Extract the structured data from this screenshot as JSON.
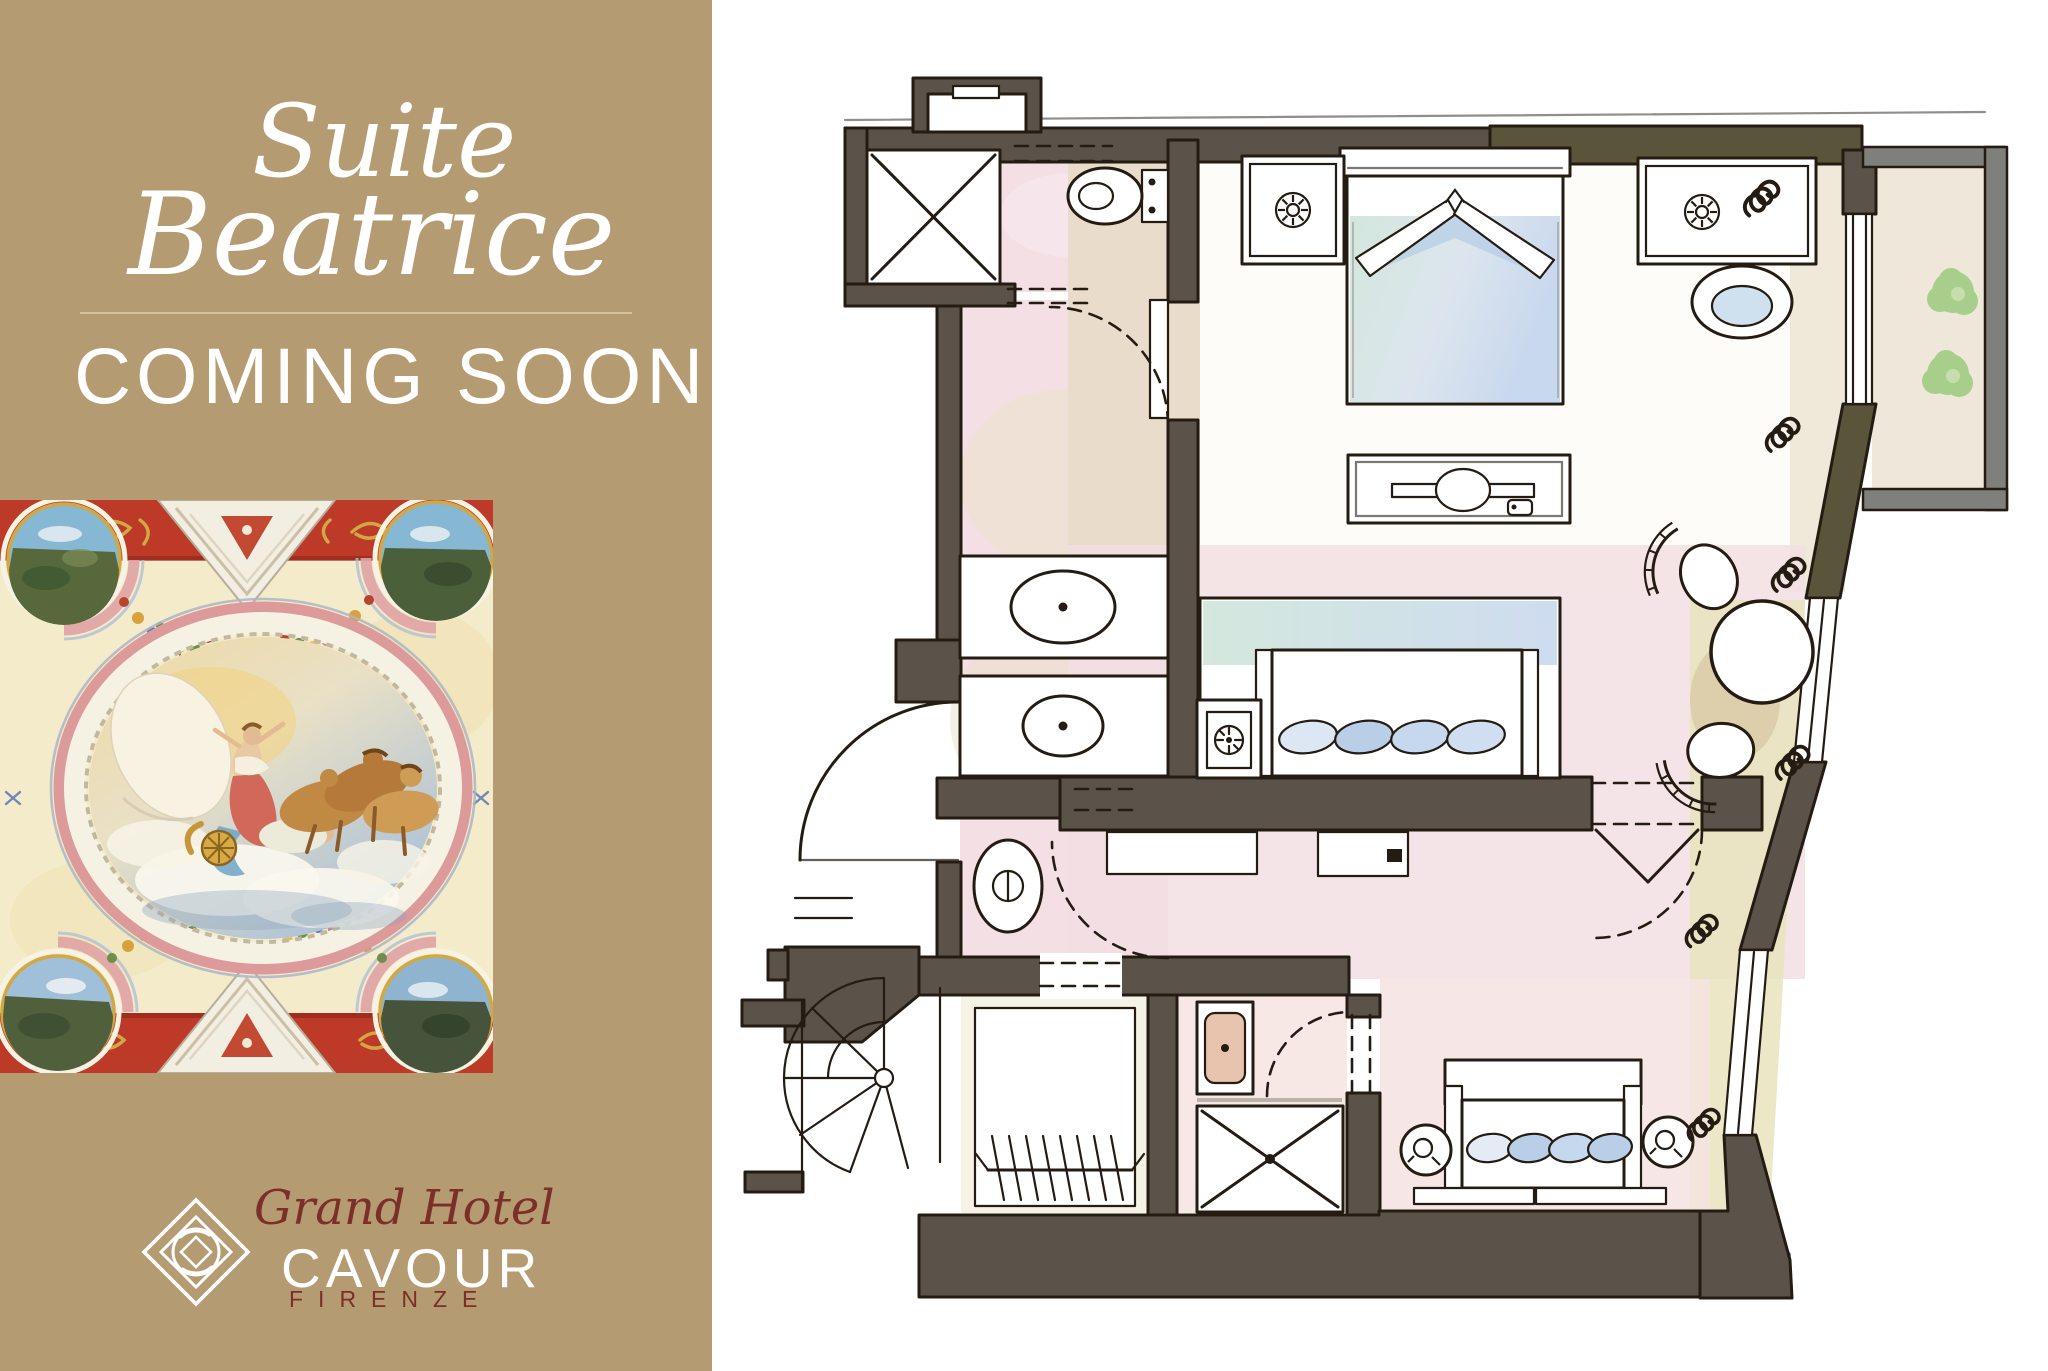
{
  "left_panel": {
    "background_color": "#b49b71",
    "text_color": "#ffffff",
    "title": {
      "line1": "Suite",
      "line2": "Beatrice"
    },
    "divider_color": "#d6c9a4",
    "announcement": "COMING SOON",
    "fresco": {
      "icon": "ceiling-fresco-image",
      "palette": {
        "field_cream": "#f4ebca",
        "band_red": "#bc3a27",
        "ornament_gold": "#d2a845",
        "oval_ring_pink": "#dd9a9b",
        "sky_gold": "#eed9a0",
        "sky_blue": "#a9c0d8",
        "figure_coral": "#d2685a",
        "horses_tan": "#bb8748",
        "drape_blue": "#6fa3c8"
      }
    },
    "logo": {
      "emblem_icon": "diamond-knot-icon",
      "emblem_color": "#ffffff",
      "script_text": "Grand Hotel",
      "script_color": "#7c2f28",
      "name_text": "CAVOUR",
      "name_color": "#ffffff",
      "city_text": "FIRENZE",
      "city_color": "#7c2f28"
    }
  },
  "floor_plan": {
    "icon": "suite-floor-plan-drawing",
    "wall_color": "#5b5249",
    "wall_olive_color": "#59543a",
    "balcony_wall_color": "#7f7f7b",
    "ink_color": "#241c13",
    "washes": {
      "bathroom_pink": "#f3dfe4",
      "hall_beige": "#e9dcca",
      "terrace_cream": "#efe8da",
      "window_side_green": "#e9e4bd",
      "bed_mint": "#cfe5da",
      "bed_blue": "#c3d4ec",
      "plant_green": "#a3cc86",
      "basin_tan": "#e8c3ad"
    },
    "features": [
      "shower-stall-icon",
      "toilet-icon",
      "washbasin-icon",
      "washbasin-icon",
      "bidet-icon",
      "entrance-door-arc",
      "spiral-staircase-icon",
      "wardrobe-rail-icon",
      "second-shower-stall-icon",
      "second-washbasin-icon",
      "double-bed-icon",
      "nightstand-lamp-icon",
      "nightstand-lamp-icon",
      "bedside-seat-icon",
      "luggage-bench-icon",
      "day-bed-icon",
      "safe-icon",
      "console-icon",
      "dining-table-icon",
      "chair-icon",
      "chair-icon",
      "sofa-icon",
      "side-table-icon",
      "side-table-icon",
      "radiator-icon",
      "french-window-icon",
      "balcony-terrace",
      "potted-plant-icon"
    ]
  }
}
